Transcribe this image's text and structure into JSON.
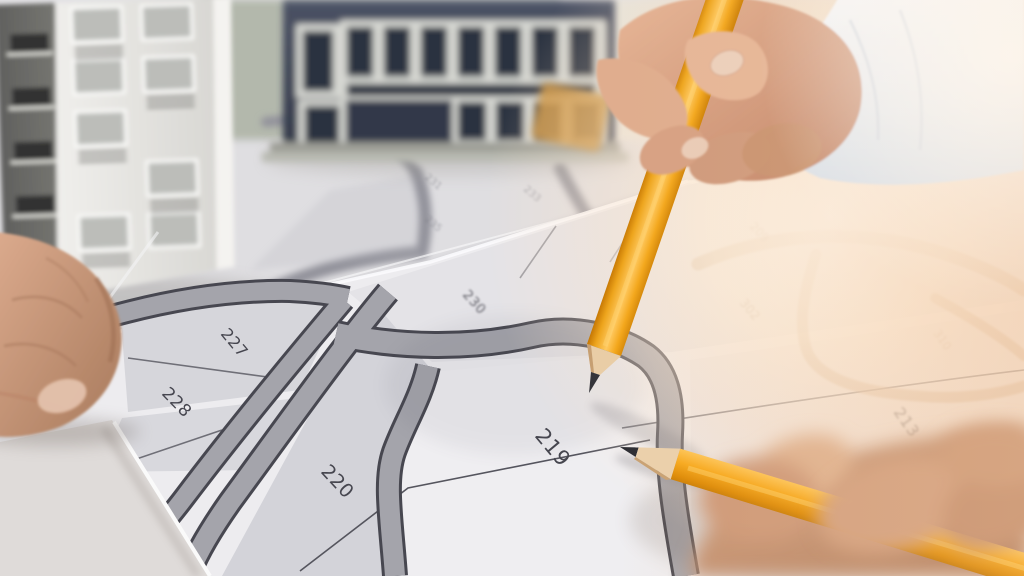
{
  "map": {
    "parcels": [
      {
        "label": "219"
      },
      {
        "label": "220"
      },
      {
        "label": "227"
      },
      {
        "label": "228"
      },
      {
        "label": "230"
      },
      {
        "label": "213"
      }
    ],
    "washed_parcels": [
      {
        "label": "209"
      },
      {
        "label": "302"
      },
      {
        "label": "310"
      }
    ],
    "faint_parcels": [
      {
        "label": "231"
      },
      {
        "label": "233"
      },
      {
        "label": "222"
      },
      {
        "label": "235"
      }
    ]
  },
  "colors": {
    "paper": "#edecef",
    "parcel_gray": "#d6d6db",
    "road_fill": "#a4a4ab",
    "road_edge": "#474750",
    "label_ink": "#46464f",
    "desk": "#dfdbd9",
    "pencil_yellow": "#f7a91e",
    "pencil_wood": "#e9cda6",
    "pencil_lead": "#35353a",
    "skin": "#d3a082",
    "navy_building": "#3f4656",
    "white_building": "#ecebe8",
    "flare_warm": "#fbe3c9",
    "washed_road_tan": "#c2a07e"
  },
  "objects": [
    {
      "name": "cadastral-map-sheets"
    },
    {
      "name": "white-apartment-model"
    },
    {
      "name": "navy-building-model"
    },
    {
      "name": "pointing-hand-with-pencil-top-right"
    },
    {
      "name": "blurred-hand-with-pencil-bottom-right"
    },
    {
      "name": "resting-fist-left"
    }
  ]
}
